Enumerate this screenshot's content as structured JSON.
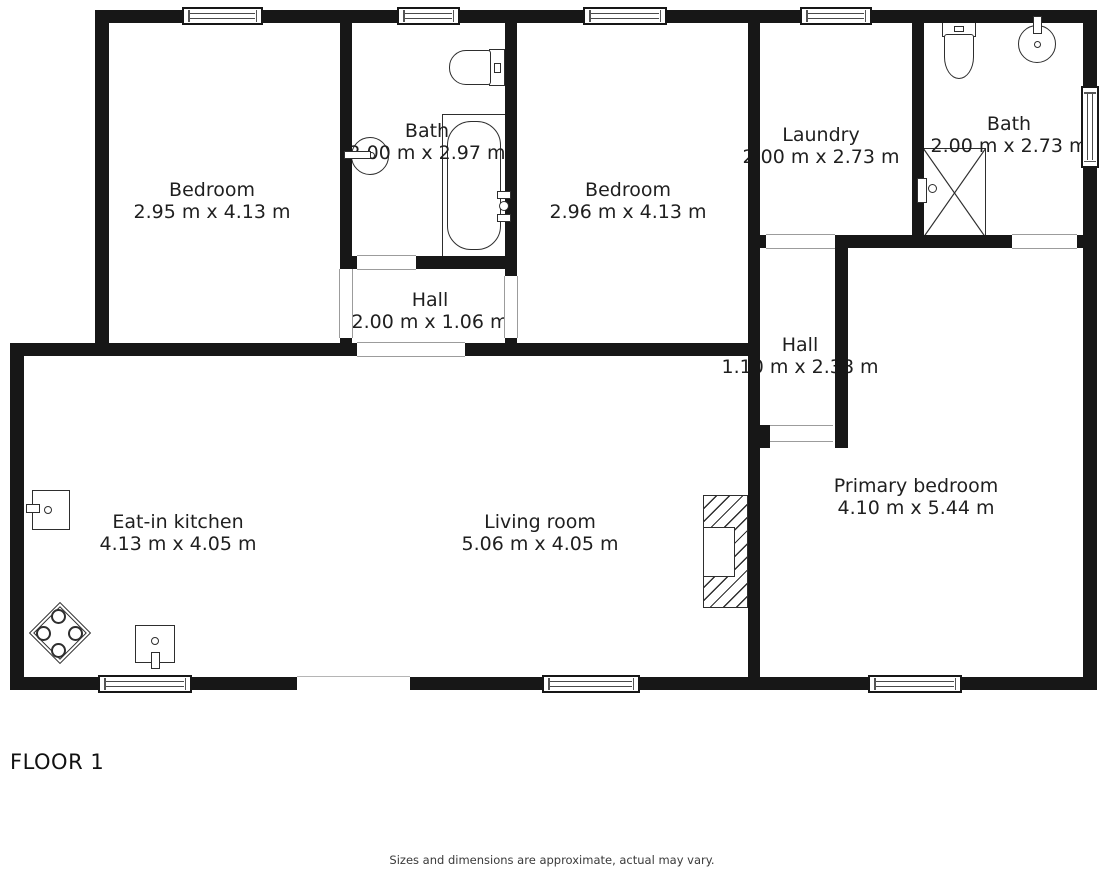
{
  "floor_label": "FLOOR 1",
  "disclaimer": "Sizes and dimensions are approximate, actual may vary.",
  "colors": {
    "wall": "#171717",
    "fixture_stroke": "#2e2e2e",
    "door_frame": "#9c9c9c",
    "text": "#1f1f1f"
  },
  "rooms": [
    {
      "name": "Bedroom",
      "dims": "2.95 m x 4.13 m"
    },
    {
      "name": "Bath",
      "dims": "2.00 m x 2.97 m"
    },
    {
      "name": "Bedroom",
      "dims": "2.96 m x 4.13 m"
    },
    {
      "name": "Laundry",
      "dims": "2.00 m x 2.73 m"
    },
    {
      "name": "Bath",
      "dims": "2.00 m x 2.73 m"
    },
    {
      "name": "Hall",
      "dims": "2.00 m x 1.06 m"
    },
    {
      "name": "Hall",
      "dims": "1.10 m x 2.38 m"
    },
    {
      "name": "Eat-in kitchen",
      "dims": "4.13 m x 4.05 m"
    },
    {
      "name": "Living room",
      "dims": "5.06 m x 4.05 m"
    },
    {
      "name": "Primary bedroom",
      "dims": "4.10 m x 5.44 m"
    }
  ],
  "fixtures": [
    "toilet-icon",
    "sink-icon",
    "bathtub-icon",
    "shower-icon",
    "stove-icon",
    "oven-icon",
    "dishwasher-icon",
    "fireplace-icon"
  ]
}
